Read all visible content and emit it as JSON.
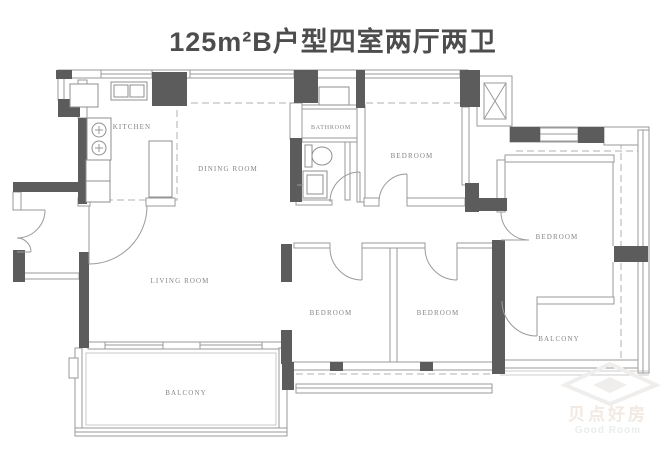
{
  "title": "125m²B户型四室两厅两卫",
  "rooms": {
    "kitchen": "KITCHEN",
    "dining_room": "DINING ROOM",
    "bathroom": "BATHROOM",
    "bedroom_top": "BEDROOM",
    "bedroom_right": "BEDROOM",
    "bedroom_mid_left": "BEDROOM",
    "bedroom_mid_right": "BEDROOM",
    "living_room": "LIVING ROOM",
    "balcony_left": "BALCONY",
    "balcony_right": "BALCONY"
  },
  "watermark": {
    "cn": "贝点好房",
    "en": "Good Room"
  },
  "colors": {
    "wall": "#5c5c5c",
    "line": "#9a9a9a",
    "label": "#858585",
    "title": "#4d4d4d",
    "watermark": "#f0eeec"
  }
}
